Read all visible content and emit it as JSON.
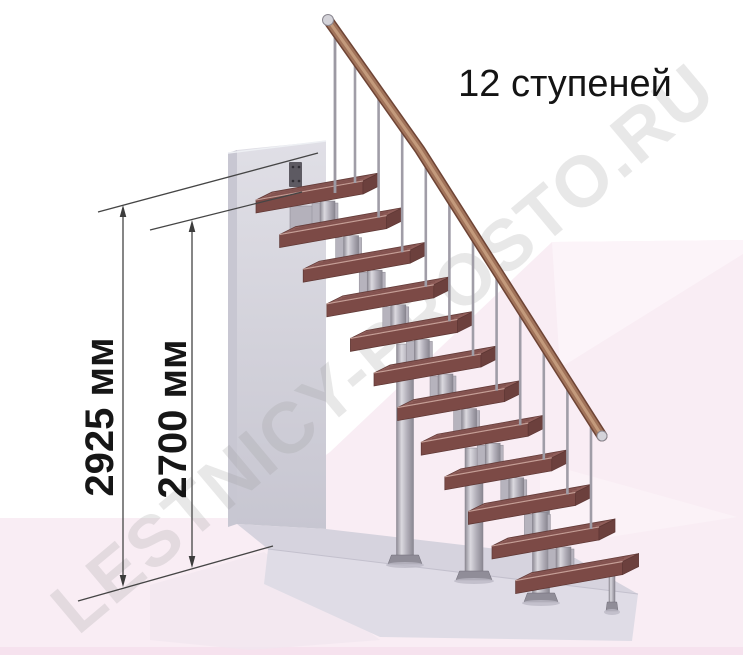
{
  "title": "12 ступеней",
  "watermark": "LESTNICY-PROSTO.RU",
  "steps_count": 12,
  "dimensions": {
    "total_height": "2925 мм",
    "to_top_tread": "2700 мм"
  },
  "colors": {
    "background": "#ffffff",
    "floor_pink": "#f9edf4",
    "floor_pink_light": "#fcf4f9",
    "bottom_strip": "#f6e2ee",
    "wall_gray": "#d6d5dd",
    "platform_top": "#d6d3de",
    "platform_front": "#dfdce6",
    "tread_top": "#905e5a",
    "tread_front": "#7c4a46",
    "tread_end": "#6c403d",
    "handrail_wood": "#a1735a",
    "metal_gray": "#a8a5ae",
    "dimension_line": "#454545",
    "text": "#141414",
    "watermark_gray": "#9a9a9a"
  }
}
